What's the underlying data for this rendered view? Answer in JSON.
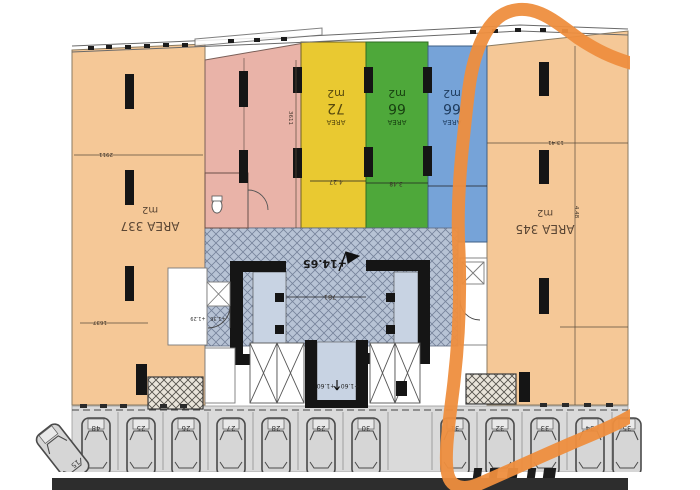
{
  "plan": {
    "title_hint": "floor-plan with highlighted right wing",
    "annotation_color": "#ee8e3e"
  },
  "units": {
    "left": {
      "area": "AREA 337",
      "unit": "m2"
    },
    "right": {
      "area": "AREA 345",
      "unit": "m2"
    },
    "yellow": {
      "word": "AREA",
      "value": "72",
      "unit": "m2"
    },
    "green": {
      "word": "AREA",
      "value": "66",
      "unit": "m2"
    },
    "blue": {
      "word": "AREA",
      "value": "66",
      "unit": "m2"
    }
  },
  "levels": {
    "terrace": "+14.65",
    "lift_a": "+1.60",
    "lift_b": "+1.60",
    "stair_a": "+1.29",
    "stair_b": "+1.36"
  },
  "dims": {
    "left_width": "2911",
    "left_lower": "1637",
    "pink_height": "3611",
    "yellow_width": "4.27",
    "green_width": "3.48",
    "core_width": "781",
    "right_upper": "13.41",
    "right_inner": "4.48"
  },
  "parking": {
    "stalls": [
      "48",
      "25",
      "26",
      "27",
      "28",
      "29",
      "30",
      "31",
      "32",
      "33",
      "34",
      "35"
    ],
    "angled": "15"
  },
  "colors": {
    "peach": "#f5c897",
    "pink": "#e9b3a8",
    "yellow": "#e9c931",
    "green": "#4ea83a",
    "blue": "#76a3d8",
    "hatch_bg": "#b7c3d5",
    "core_room": "#c8d3e3",
    "wall": "#151515",
    "bottom_bar": "#2d2d2d"
  }
}
